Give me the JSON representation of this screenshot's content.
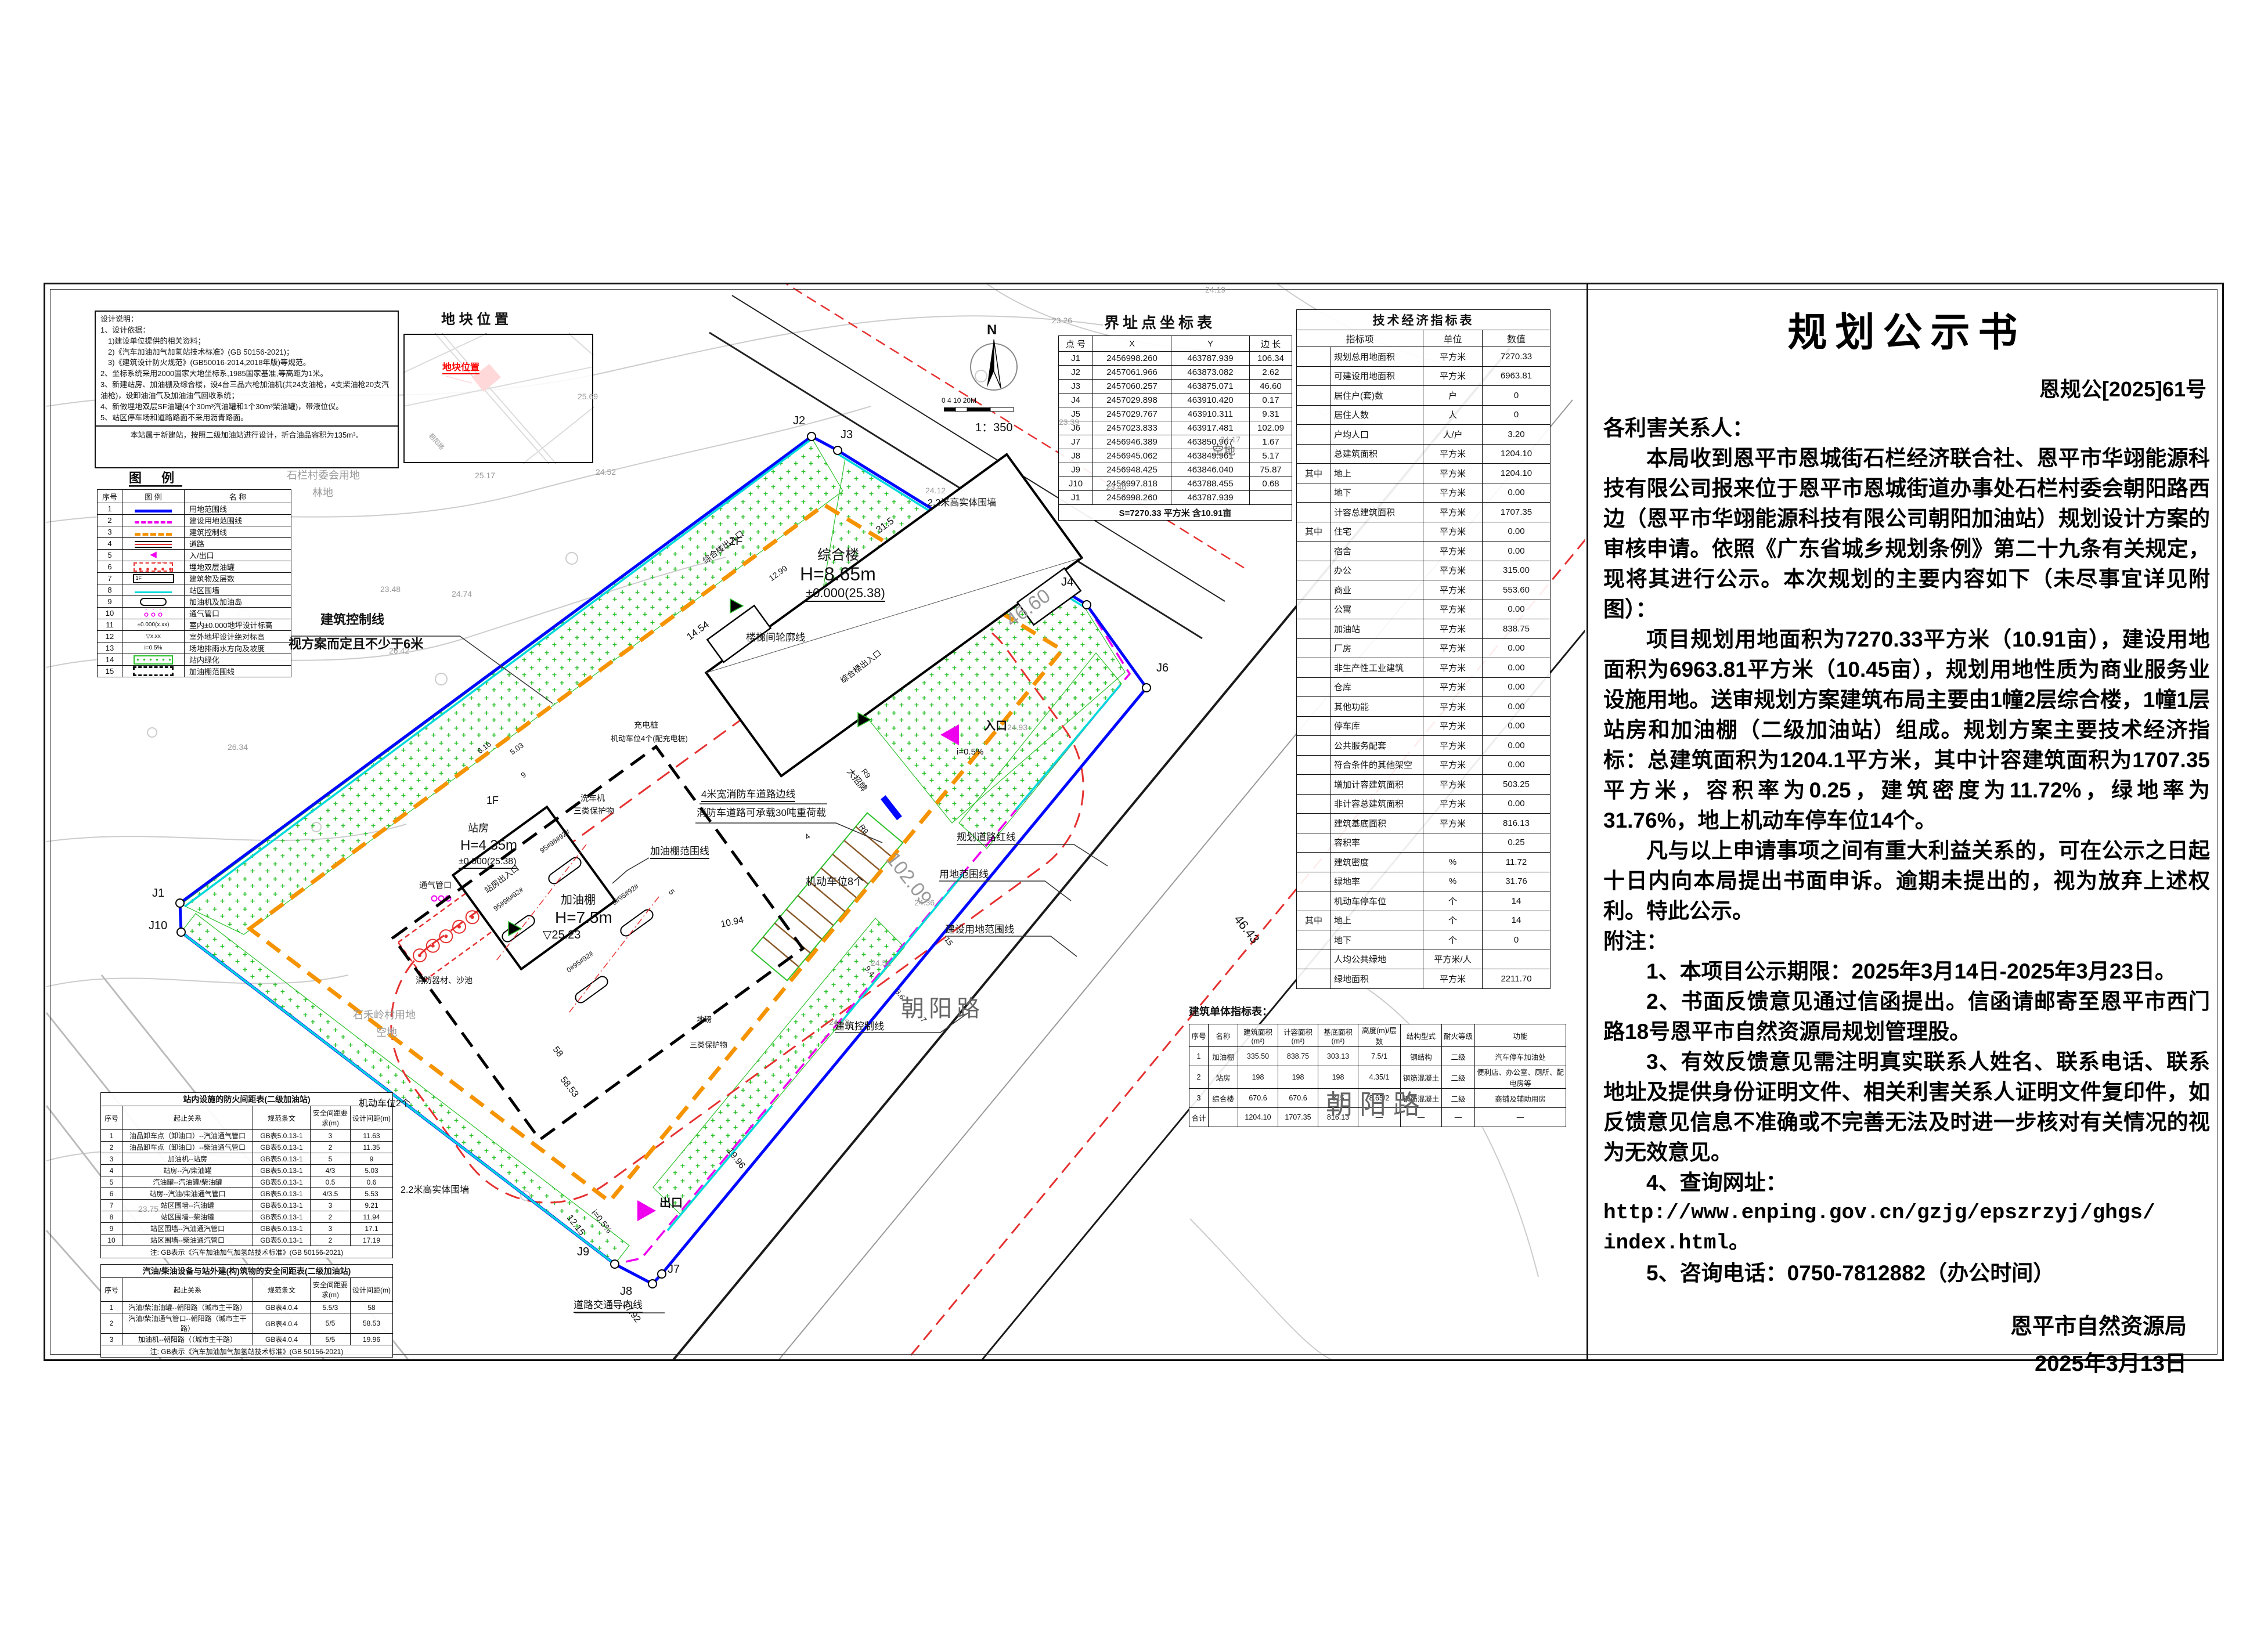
{
  "colors": {
    "boundary_blue": "#0008ff",
    "construction_magenta": "#ee00ee",
    "control_orange": "#f59300",
    "fence_cyan": "#00d9d9",
    "road_red": "#e63030",
    "greenery_green": "#2cc22c",
    "site_marker_red": "#ff0000"
  },
  "document": {
    "title": "规划公示书",
    "number": "恩规公[2025]61号",
    "body": [
      {
        "t": "各利害关系人：",
        "cls": "flush"
      },
      {
        "t": "本局收到恩平市恩城街石栏经济联合社、恩平市华翊能源科技有限公司报来位于恩平市恩城街道办事处石栏村委会朝阳路西边（恩平市华翊能源科技有限公司朝阳加油站）规划设计方案的审核申请。依照《广东省城乡规划条例》第二十九条有关规定，现将其进行公示。本次规划的主要内容如下（未尽事宜详见附图）：",
        "cls": "ind"
      },
      {
        "t": "项目规划用地面积为7270.33平方米（10.91亩），建设用地面积为6963.81平方米（10.45亩），规划用地性质为商业服务业设施用地。送审规划方案建筑布局主要由1幢2层综合楼，1幢1层站房和加油棚（二级加油站）组成。规划方案主要技术经济指标：总建筑面积为1204.1平方米，其中计容建筑面积为1707.35平方米，容积率为0.25，建筑密度为11.72%，绿地率为31.76%，地上机动车停车位14个。",
        "cls": "ind"
      },
      {
        "t": "凡与以上申请事项之间有重大利益关系的，可在公示之日起十日内向本局提出书面申诉。逾期未提出的，视为放弃上述权利。特此公示。",
        "cls": "ind"
      },
      {
        "t": "附注：",
        "cls": "flush"
      },
      {
        "t": "1、本项目公示期限：2025年3月14日-2025年3月23日。",
        "cls": "ind"
      },
      {
        "t": "2、书面反馈意见通过信函提出。信函请邮寄至恩平市西门路18号恩平市自然资源局规划管理股。",
        "cls": "ind"
      },
      {
        "t": "3、有效反馈意见需注明真实联系人姓名、联系电话、联系地址及提供身份证明文件、相关利害关系人证明文件复印件，如反馈意见信息不准确或不完善无法及时进一步核对有关情况的视为无效意见。",
        "cls": "ind"
      },
      {
        "t": "4、查询网址：",
        "cls": "ind"
      },
      {
        "t": "http://www.enping.gov.cn/gzjg/epszrzyj/ghgs/",
        "cls": "url"
      },
      {
        "t": "index.html。",
        "cls": "url"
      },
      {
        "t": "5、咨询电话：0750-7812882（办公时间）",
        "cls": "ind"
      }
    ],
    "signature": "恩平市自然资源局",
    "date": "2025年3月13日"
  },
  "design_notes": {
    "lines": [
      "设计说明：",
      "1、设计依据：",
      "　1)建设单位提供的相关资料；",
      "　2)《汽车加油加气加氢站技术标准》(GB 50156-2021)；",
      "　3)《建筑设计防火规范》(GB50016-2014,2018年版)等规范。",
      "2、坐标系统采用2000国家大地坐标系,1985国家基准,等高距为1米。",
      "3、新建站房、加油棚及综合楼，设4台三品六枪加油机(共24支油枪，4支柴油枪20支汽油枪)，设卸油油气及加油油气回收系统；",
      "4、新做埋地双层SF油罐(4个30m³汽油罐和1个30m³柴油罐)，带液位仪。",
      "5、站区停车场和道路路面不采用沥青路面。"
    ],
    "footnote": "本站属于新建站，按照二级加油站进行设计，折合油品容积为135m³。"
  },
  "legend": {
    "title": "图 例",
    "headers": [
      "序号",
      "图 例",
      "名 称"
    ],
    "items": [
      {
        "n": "1",
        "name": "用地范围线",
        "sym": "s-blue",
        "symtext": ""
      },
      {
        "n": "2",
        "name": "建设用地范围线",
        "sym": "s-mg",
        "symtext": ""
      },
      {
        "n": "3",
        "name": "建筑控制线",
        "sym": "s-or",
        "symtext": ""
      },
      {
        "n": "4",
        "name": "道路",
        "sym": "s-road",
        "symtext": ""
      },
      {
        "n": "5",
        "name": "入/出口",
        "sym": "s-arr",
        "symtext": "◀"
      },
      {
        "n": "6",
        "name": "埋地双层油罐",
        "sym": "s-tank",
        "symtext": ""
      },
      {
        "n": "7",
        "name": "建筑物及层数",
        "sym": "s-bld",
        "symtext": "1F"
      },
      {
        "n": "8",
        "name": "站区围墙",
        "sym": "s-fence",
        "symtext": ""
      },
      {
        "n": "9",
        "name": "加油机及加油岛",
        "sym": "s-disp",
        "symtext": ""
      },
      {
        "n": "10",
        "name": "通气管口",
        "sym": "s-vent",
        "symtext": ""
      },
      {
        "n": "11",
        "name": "室内±0.000地坪设计标高",
        "sym": "s-lvlin",
        "symtext": "±0.000(x.xx)"
      },
      {
        "n": "12",
        "name": "室外地坪设计绝对标高",
        "sym": "s-lvlout",
        "symtext": "▽x.xx"
      },
      {
        "n": "13",
        "name": "场地排雨水方向及坡度",
        "sym": "s-slope",
        "symtext": "i=0.5%"
      },
      {
        "n": "14",
        "name": "站内绿化",
        "sym": "s-green",
        "symtext": ""
      },
      {
        "n": "15",
        "name": "加油棚范围线",
        "sym": "s-canopy",
        "symtext": ""
      }
    ]
  },
  "location_map": {
    "title": "地 块 位 置",
    "marker": "地块位置",
    "road": "朝阳路"
  },
  "compass": {
    "n": "N",
    "bar": "0 4 10      20M",
    "scale": "1：350"
  },
  "boundary_table": {
    "title": "界址点坐标表",
    "headers": [
      "点 号",
      "X",
      "Y",
      "边 长"
    ],
    "rows": [
      {
        "p": "J1",
        "x": "2456998.260",
        "y": "463787.939",
        "len": "106.34"
      },
      {
        "p": "J2",
        "x": "2457061.966",
        "y": "463873.082",
        "len": "2.62"
      },
      {
        "p": "J3",
        "x": "2457060.257",
        "y": "463875.071",
        "len": "46.60"
      },
      {
        "p": "J4",
        "x": "2457029.898",
        "y": "463910.420",
        "len": "0.17"
      },
      {
        "p": "J5",
        "x": "2457029.767",
        "y": "463910.311",
        "len": "9.31"
      },
      {
        "p": "J6",
        "x": "2457023.833",
        "y": "463917.481",
        "len": "102.09"
      },
      {
        "p": "J7",
        "x": "2456946.389",
        "y": "463850.967",
        "len": "1.67"
      },
      {
        "p": "J8",
        "x": "2456945.062",
        "y": "463849.961",
        "len": "5.17"
      },
      {
        "p": "J9",
        "x": "2456948.425",
        "y": "463846.040",
        "len": "75.87"
      },
      {
        "p": "J10",
        "x": "2456997.818",
        "y": "463788.455",
        "len": "0.68"
      },
      {
        "p": "J1",
        "x": "2456998.260",
        "y": "463787.939",
        "len": ""
      }
    ],
    "footer": "S=7270.33 平方米 含10.91亩"
  },
  "tech_table": {
    "title": "技术经济指标表",
    "headers": [
      "指标项",
      "单位",
      "数值"
    ],
    "rows": [
      {
        "g": "",
        "l": "规划总用地面积",
        "u": "平方米",
        "v": "7270.33"
      },
      {
        "g": "",
        "l": "可建设用地面积",
        "u": "平方米",
        "v": "6963.81"
      },
      {
        "g": "",
        "l": "居住户(套)数",
        "u": "户",
        "v": "0"
      },
      {
        "g": "",
        "l": "居住人数",
        "u": "人",
        "v": "0"
      },
      {
        "g": "",
        "l": "户均人口",
        "u": "人/户",
        "v": "3.20"
      },
      {
        "g": "",
        "l": "总建筑面积",
        "u": "平方米",
        "v": "1204.10"
      },
      {
        "g": "其中",
        "l": "地上",
        "u": "平方米",
        "v": "1204.10"
      },
      {
        "g": "",
        "l": "地下",
        "u": "平方米",
        "v": "0.00"
      },
      {
        "g": "",
        "l": "计容总建筑面积",
        "u": "平方米",
        "v": "1707.35"
      },
      {
        "g": "其中",
        "l": "住宅",
        "u": "平方米",
        "v": "0.00"
      },
      {
        "g": "",
        "l": "宿舍",
        "u": "平方米",
        "v": "0.00"
      },
      {
        "g": "",
        "l": "办公",
        "u": "平方米",
        "v": "315.00"
      },
      {
        "g": "",
        "l": "商业",
        "u": "平方米",
        "v": "553.60"
      },
      {
        "g": "",
        "l": "公寓",
        "u": "平方米",
        "v": "0.00"
      },
      {
        "g": "",
        "l": "加油站",
        "u": "平方米",
        "v": "838.75"
      },
      {
        "g": "",
        "l": "厂房",
        "u": "平方米",
        "v": "0.00"
      },
      {
        "g": "",
        "l": "非生产性工业建筑",
        "u": "平方米",
        "v": "0.00"
      },
      {
        "g": "",
        "l": "仓库",
        "u": "平方米",
        "v": "0.00"
      },
      {
        "g": "",
        "l": "其他功能",
        "u": "平方米",
        "v": "0.00"
      },
      {
        "g": "",
        "l": "停车库",
        "u": "平方米",
        "v": "0.00"
      },
      {
        "g": "",
        "l": "公共服务配套",
        "u": "平方米",
        "v": "0.00"
      },
      {
        "g": "",
        "l": "符合条件的其他架空",
        "u": "平方米",
        "v": "0.00"
      },
      {
        "g": "",
        "l": "增加计容建筑面积",
        "u": "平方米",
        "v": "503.25"
      },
      {
        "g": "",
        "l": "非计容总建筑面积",
        "u": "平方米",
        "v": "0.00"
      },
      {
        "g": "",
        "l": "建筑基底面积",
        "u": "平方米",
        "v": "816.13"
      },
      {
        "g": "",
        "l": "容积率",
        "u": "",
        "v": "0.25"
      },
      {
        "g": "",
        "l": "建筑密度",
        "u": "%",
        "v": "11.72"
      },
      {
        "g": "",
        "l": "绿地率",
        "u": "%",
        "v": "31.76"
      },
      {
        "g": "",
        "l": "机动车停车位",
        "u": "个",
        "v": "14"
      },
      {
        "g": "其中",
        "l": "地上",
        "u": "个",
        "v": "14"
      },
      {
        "g": "",
        "l": "地下",
        "u": "个",
        "v": "0"
      },
      {
        "g": "",
        "l": "人均公共绿地",
        "u": "平方米/人",
        "v": ""
      },
      {
        "g": "",
        "l": "绿地面积",
        "u": "平方米",
        "v": "2211.70"
      }
    ]
  },
  "building_table": {
    "title": "建筑单体指标表：",
    "headers": [
      "序号",
      "名称",
      "建筑面积(m²)",
      "计容面积(m²)",
      "基底面积(m²)",
      "高度(m)/层数",
      "结构型式",
      "耐火等级",
      "功能"
    ],
    "rows": [
      {
        "n": "1",
        "name": "加油棚",
        "a": "335.50",
        "b": "838.75",
        "c": "303.13",
        "h": "7.5/1",
        "s": "钢结构",
        "f": "二级",
        "func": "汽车停车加油处"
      },
      {
        "n": "2",
        "name": "站房",
        "a": "198",
        "b": "198",
        "c": "198",
        "h": "4.35/1",
        "s": "钢筋混凝土",
        "f": "二级",
        "func": "便利店、办公室、厕所、配电房等"
      },
      {
        "n": "3",
        "name": "综合楼",
        "a": "670.6",
        "b": "670.6",
        "c": "315",
        "h": "8.65/2",
        "s": "钢筋混凝土",
        "f": "二级",
        "func": "商铺及辅助用房"
      },
      {
        "n": "合计",
        "name": "",
        "a": "1204.10",
        "b": "1707.35",
        "c": "816.13",
        "h": "—",
        "s": "—",
        "f": "—",
        "func": "—"
      }
    ]
  },
  "spacing_table_1": {
    "title": "站内设施的防火间距表(二级加油站)",
    "headers": [
      "序号",
      "起止关系",
      "规范条文",
      "安全间距要求(m)",
      "设计间距(m)"
    ],
    "rows": [
      {
        "n": "1",
        "r": "油品卸车点（卸油口）--汽油通气管口",
        "c": "GB表5.0.13-1",
        "req": "3",
        "des": "11.63"
      },
      {
        "n": "2",
        "r": "油品卸车点（卸油口）--柴油通气管口",
        "c": "GB表5.0.13-1",
        "req": "2",
        "des": "11.35"
      },
      {
        "n": "3",
        "r": "加油机--站房",
        "c": "GB表5.0.13-1",
        "req": "5",
        "des": "9"
      },
      {
        "n": "4",
        "r": "站房--汽/柴油罐",
        "c": "GB表5.0.13-1",
        "req": "4/3",
        "des": "5.03"
      },
      {
        "n": "5",
        "r": "汽油罐--汽油罐/柴油罐",
        "c": "GB表5.0.13-1",
        "req": "0.5",
        "des": "0.6"
      },
      {
        "n": "6",
        "r": "站房--汽油/柴油通气管口",
        "c": "GB表5.0.13-1",
        "req": "4/3.5",
        "des": "5.53"
      },
      {
        "n": "7",
        "r": "站区围墙--汽油罐",
        "c": "GB表5.0.13-1",
        "req": "3",
        "des": "9.21"
      },
      {
        "n": "8",
        "r": "站区围墙--柴油罐",
        "c": "GB表5.0.13-1",
        "req": "2",
        "des": "11.94"
      },
      {
        "n": "9",
        "r": "站区围墙--汽油通汽管口",
        "c": "GB表5.0.13-1",
        "req": "3",
        "des": "17.1"
      },
      {
        "n": "10",
        "r": "站区围墙--柴油通汽管口",
        "c": "GB表5.0.13-1",
        "req": "2",
        "des": "17.19"
      }
    ],
    "note": "注: GB表示《汽车加油加气加氢站技术标准》(GB 50156-2021)"
  },
  "spacing_table_2": {
    "title": "汽油/柴油设备与站外建(构)筑物的安全间距表(二级加油站)",
    "headers": [
      "序号",
      "起止关系",
      "规范条文",
      "安全间距要求(m)",
      "设计间距(m)"
    ],
    "rows": [
      {
        "n": "1",
        "r": "汽油/柴油油罐--朝阳路（城市主干路）",
        "c": "GB表4.0.4",
        "req": "5.5/3",
        "des": "58"
      },
      {
        "n": "2",
        "r": "汽油/柴油通气管口--朝阳路（城市主干路）",
        "c": "GB表4.0.4",
        "req": "5/5",
        "des": "58.53"
      },
      {
        "n": "3",
        "r": "加油机--朝阳路（（城市主干路）",
        "c": "GB表4.0.4",
        "req": "5/5",
        "des": "19.96"
      }
    ],
    "note": "注: GB表示《汽车加油加气加氢站技术标准》(GB 50156-2021)"
  },
  "plan": {
    "points": {
      "j1": "J1",
      "j2": "J2",
      "j3": "J3",
      "j4": "J4",
      "j5": "J5",
      "j6": "J6",
      "j7": "J7",
      "j8": "J8",
      "j9": "J9",
      "j10": "J10"
    },
    "buildings": {
      "zonghelou": {
        "name": "综合楼",
        "height": "H=8.65m",
        "level": "±0.000(25.38)",
        "floors": "2F"
      },
      "zhanfang": {
        "name": "站房",
        "height": "H=4.35m",
        "level": "±0.000(25.38)",
        "floors": "1F"
      },
      "jiayoupeng": {
        "name": "加油棚",
        "height": "H=7.5m",
        "level": "▽25.23"
      }
    },
    "labels": {
      "road_name": "朝阳路",
      "guihua_red": "规划道路红线",
      "yongdi": "用地范围线",
      "jianshe": "建设用地范围线",
      "kongzhi": "建筑控制线",
      "kongzhi_note": "视方案而定且不少于6米",
      "fire_edge": "4米宽消防车道路边线",
      "fire_load": "消防车道路可承载30吨重荷载",
      "parking8": "机动车位8个",
      "parking2": "机动车位2个",
      "sign": "大招牌",
      "canopy_line": "加油棚范围线",
      "stair": "楼梯间轮廓线",
      "zh_entry": "综合楼出入口",
      "zf_entry": "站房出入口",
      "washer": "洗车机",
      "protect3": "三类保护物",
      "charger": "充电桩",
      "charger_note": "机动车位4个(配充电桩)",
      "vent": "通气管口",
      "fire_sand": "消防器材、沙池",
      "wall22": "2.2米高实体围墙",
      "guide": "道路交通导向线",
      "entry": "入口",
      "exit": "出口",
      "slope": "i=0.5%",
      "weighbridge": "地磅",
      "kongdi": "空地",
      "shilan1": "石栏村委会用地",
      "shilan2": "林地",
      "shiheling": "石禾岭村用地",
      "island_a": "95#98#92#",
      "island_b": "0#95#92#"
    },
    "dims": {
      "d1": "31.5",
      "d2": "46.60",
      "d3": "14.54",
      "d4": "12.99",
      "d5": "102.09",
      "d6": "46.43",
      "d7": "58",
      "d8": "58.53",
      "d9": "19.96",
      "d10": "12.15",
      "d11": "17.92",
      "d12": "10.94",
      "d13": "9.4",
      "d14": "3.6",
      "d15": "7",
      "d16": "15",
      "d17": "5",
      "d18": "4",
      "d19": "9",
      "d20": "6.16",
      "d21": "5.03",
      "r9": "R9"
    },
    "spots": [
      "23.26",
      "24.19",
      "24.17",
      "23.39",
      "23.40",
      "25.69",
      "25.17",
      "24.52",
      "26.34",
      "23.48",
      "24.74",
      "26.42",
      "24.12",
      "24.36",
      "24.51",
      "24.73",
      "23.75",
      "24.93"
    ]
  }
}
